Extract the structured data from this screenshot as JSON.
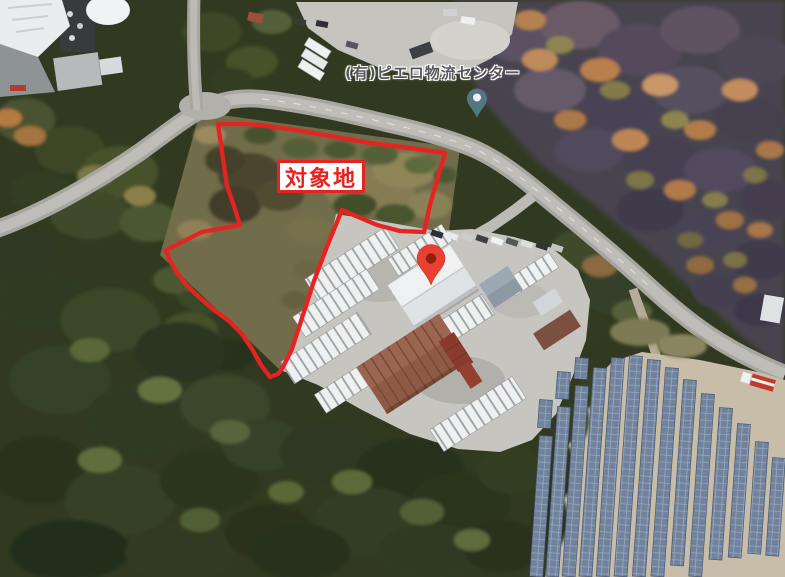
{
  "map": {
    "type": "satellite-aerial-view",
    "site_boundary_label": "対象地",
    "business_label": "(有)ピエロ物流センター",
    "icons": {
      "red_pin": "destination-pin-icon",
      "teal_pin": "business-pin-icon"
    },
    "colors": {
      "boundary_red": "#e62320",
      "site_label_text": "#e62320",
      "site_label_bg": "#ffffff",
      "business_label_text": "#58585c",
      "red_pin_fill": "#e8412f",
      "red_pin_core": "#8f1d10",
      "teal_pin_fill": "#527682",
      "teal_pin_core": "#eef2f2",
      "road_gray": "#a8a6a1",
      "yard_paving": "#c7c5c0",
      "solar_panel_blue": "#71829c",
      "solar_ground_tan": "#c8bda8",
      "forest_green": "#313a20",
      "autumn_dusk": "#4c4452"
    }
  }
}
